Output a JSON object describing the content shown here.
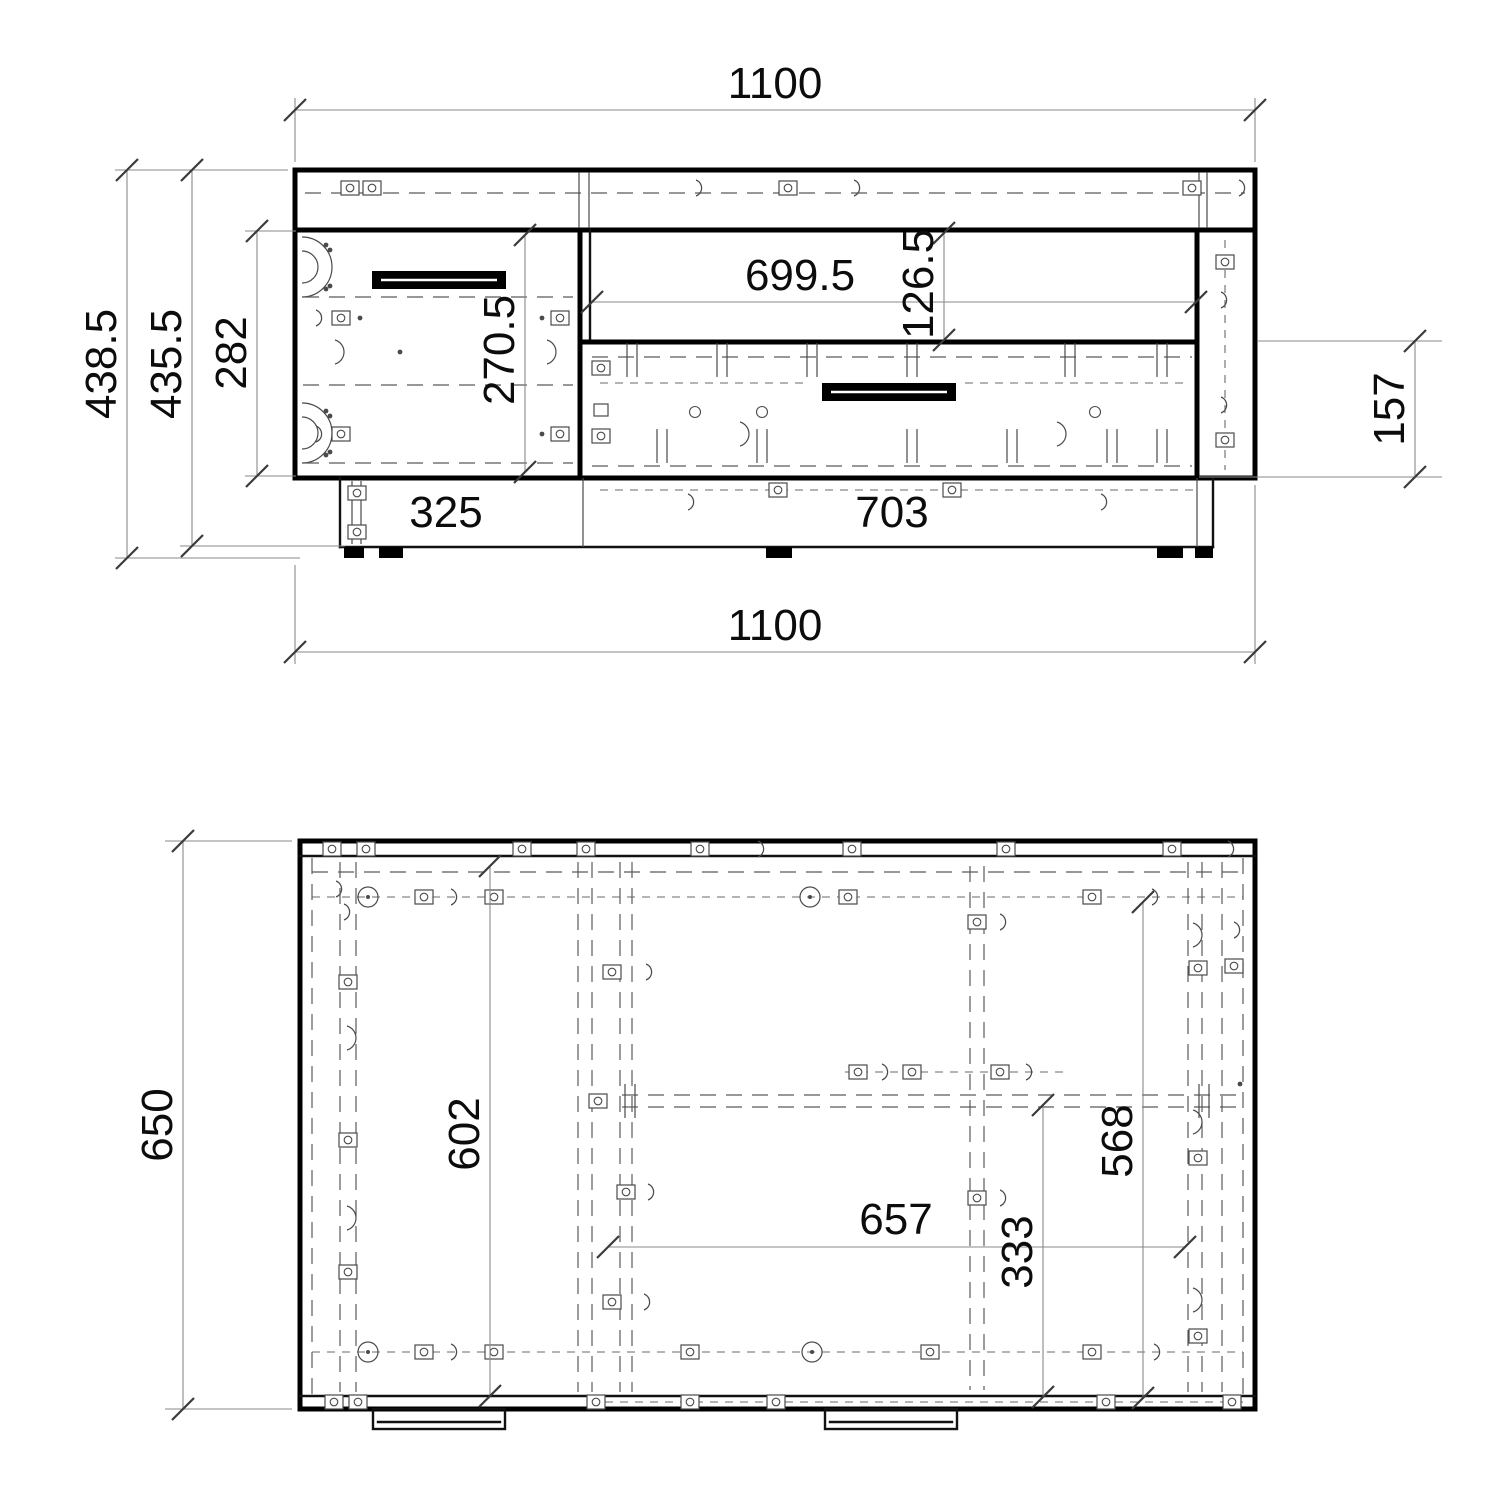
{
  "front": {
    "width_top": "1100",
    "width_bottom": "1100",
    "height_overall": "438.5",
    "height_body": "435.5",
    "height_opening": "282",
    "height_door": "270.5",
    "width_shelf": "699.5",
    "height_shelf": "126.5",
    "height_drawer": "157",
    "width_plinth_left": "325",
    "width_plinth_right": "703"
  },
  "plan": {
    "depth_overall": "650",
    "depth_interior": "602",
    "depth_drawer": "568",
    "width_interior": "657",
    "depth_drawer_inner": "333"
  }
}
